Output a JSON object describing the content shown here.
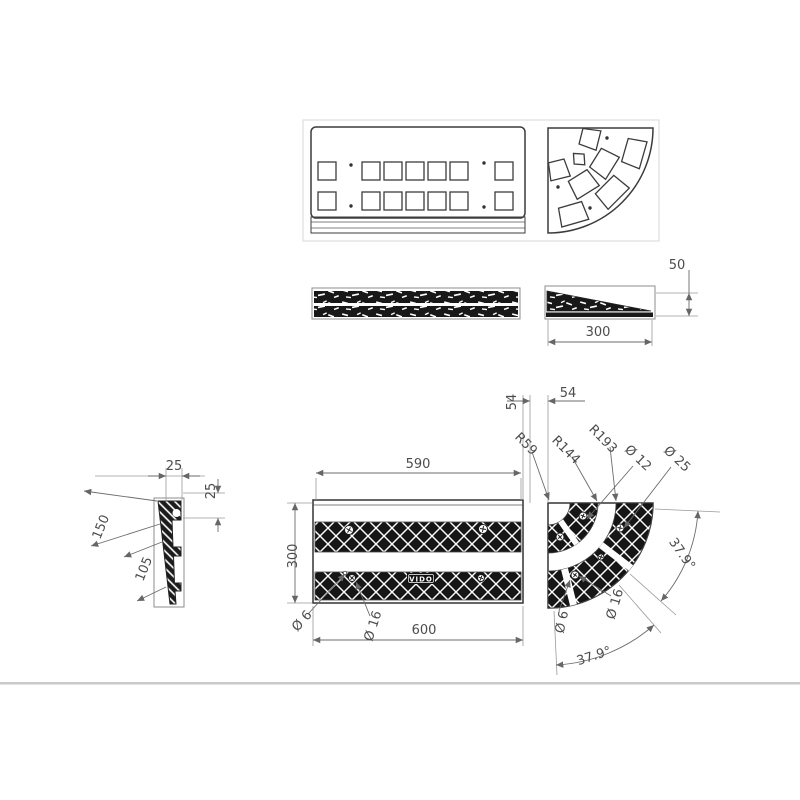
{
  "drawing": {
    "type": "technical-drawing",
    "subject": "rubber kerb ramp with corner section - multi-view dimensioned drawing",
    "colors": {
      "ink": "#3c3c3c",
      "dim_lines": "#6b6b6b",
      "pattern_fill": "#161616",
      "divider": "#c9c9c9",
      "background": "#ffffff"
    },
    "brand": {
      "label": "VIDO"
    },
    "labels": {
      "height50": "50",
      "wedge_depth": "300",
      "plan_width_top": "590",
      "plan_width_bottom": "600",
      "plan_depth": "300",
      "gap_h": "54",
      "gap_v": "54",
      "radius_small": "R59",
      "radius_mid": "R144",
      "radius_large": "R193",
      "dia12": "Ø 12",
      "dia25": "Ø 25",
      "angle_right": "37.9°",
      "angle_bottom": "37.9°",
      "corner_dia16": "Ø 16",
      "corner_dia6": "Ø 6",
      "plan_dia6": "Ø 6",
      "plan_dia16": "Ø 16",
      "section_top25": "25",
      "section_side25": "25",
      "section_len150": "150",
      "section_len105": "105"
    }
  }
}
